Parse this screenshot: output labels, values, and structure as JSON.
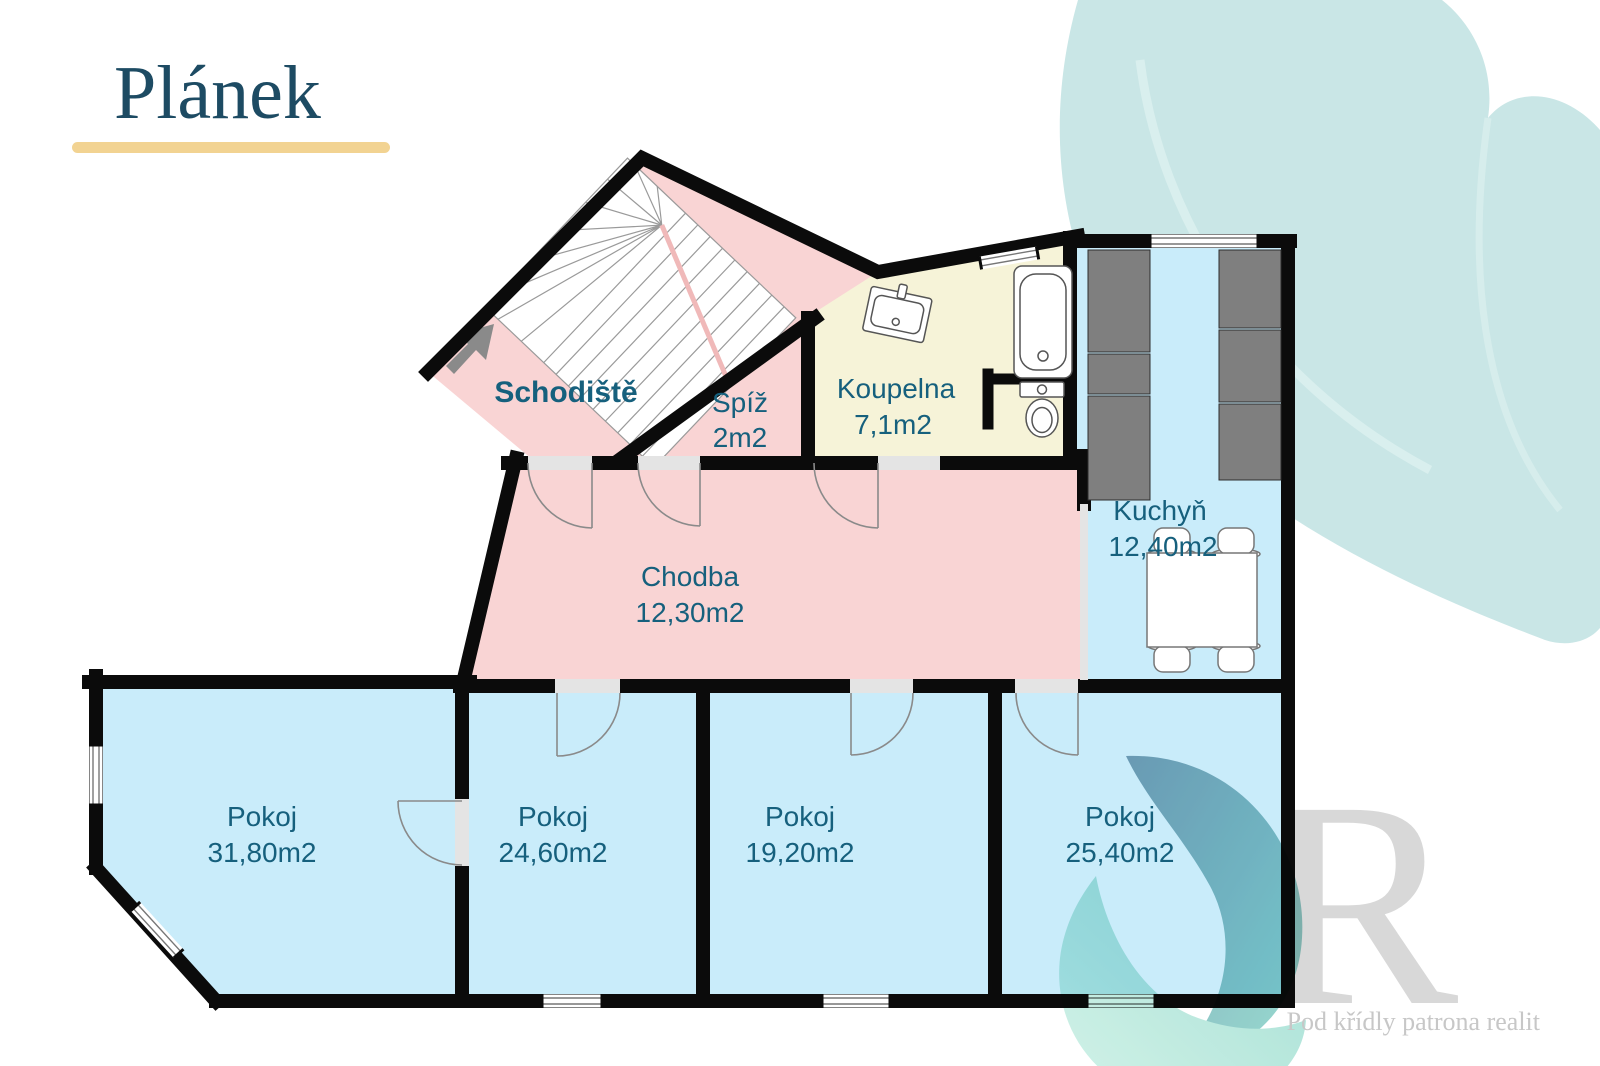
{
  "page": {
    "title": "Plánek"
  },
  "branding": {
    "watermark_letter": "R",
    "tagline": "Pod křídly patrona realit",
    "logo_icon": "patron-swirl-icon"
  },
  "rooms": [
    {
      "id": "schodiste",
      "name": "Schodiště",
      "area": ""
    },
    {
      "id": "spiz",
      "name": "Spíž",
      "area": "2m2"
    },
    {
      "id": "koupelna",
      "name": "Koupelna",
      "area": "7,1m2"
    },
    {
      "id": "kuchyn",
      "name": "Kuchyň",
      "area": "12,40m2"
    },
    {
      "id": "chodba",
      "name": "Chodba",
      "area": "12,30m2"
    },
    {
      "id": "pokoj_1",
      "name": "Pokoj",
      "area": "31,80m2"
    },
    {
      "id": "pokoj_2",
      "name": "Pokoj",
      "area": "24,60m2"
    },
    {
      "id": "pokoj_3",
      "name": "Pokoj",
      "area": "19,20m2"
    },
    {
      "id": "pokoj_4",
      "name": "Pokoj",
      "area": "25,40m2"
    }
  ],
  "colors": {
    "wall": "#0b0b0b",
    "room_pink": "#f9d4d4",
    "room_blue": "#c9ecfa",
    "room_yellow": "#f6f3d8",
    "cabinet_gray": "#7f7f7f",
    "door_gap": "#e4e4e4",
    "label": "#16607d",
    "title": "#1d4b63",
    "underline": "#f2d392",
    "leaf": "#c9e6e6",
    "logo_teal_dark": "#6b93a8",
    "logo_teal_light": "#9fdfd0",
    "watermark_gray": "#d8d8d8",
    "tagline_gray": "#c7c7c7"
  }
}
